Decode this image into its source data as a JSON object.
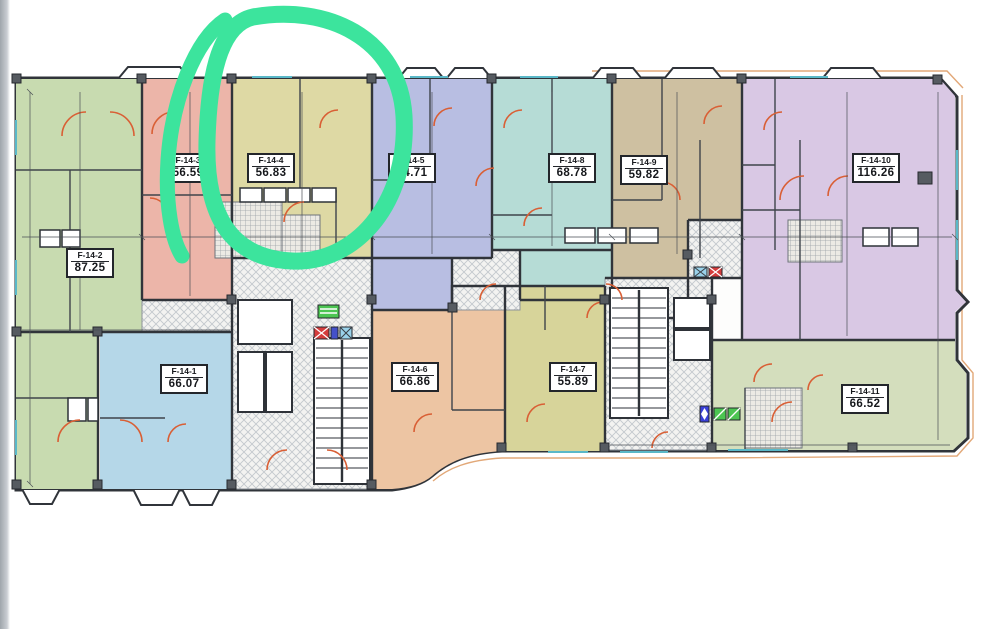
{
  "plan": {
    "title": "floor-plan-level-14",
    "units": [
      {
        "id": "F-14-1",
        "area": "66.07",
        "color": "#b5d7e8"
      },
      {
        "id": "F-14-2",
        "area": "87.25",
        "color": "#c8dbb0"
      },
      {
        "id": "F-14-3",
        "area": "56.59",
        "color": "#ecb5a9"
      },
      {
        "id": "F-14-4",
        "area": "56.83",
        "color": "#ded9a4"
      },
      {
        "id": "F-14-5",
        "area": "54.71",
        "color": "#b8bee2"
      },
      {
        "id": "F-14-6",
        "area": "66.86",
        "color": "#edc5a3"
      },
      {
        "id": "F-14-7",
        "area": "55.89",
        "color": "#d7d49a"
      },
      {
        "id": "F-14-8",
        "area": "68.78",
        "color": "#b6dcd6"
      },
      {
        "id": "F-14-9",
        "area": "59.82",
        "color": "#cec0a1"
      },
      {
        "id": "F-14-10",
        "area": "116.26",
        "color": "#d9c8e4"
      },
      {
        "id": "F-14-11",
        "area": "66.52",
        "color": "#d4debd"
      }
    ],
    "colors": {
      "wall": "#30343a",
      "door_swing": "#d95f35",
      "window_glass": "#5ab8c8",
      "outer_contour": "#e2a878",
      "paper": "#fdfdfc"
    },
    "icons": {
      "elevator_green": "#4cc552",
      "shaft_red": "#d43c3c",
      "shaft_blue": "#4450c8",
      "shaft_cyan": "#9ad2ea",
      "duct_blue": "#3a40d8"
    }
  },
  "annotation": {
    "highlight_color": "#3ce49d",
    "highlighted_unit": "F-14-4"
  }
}
